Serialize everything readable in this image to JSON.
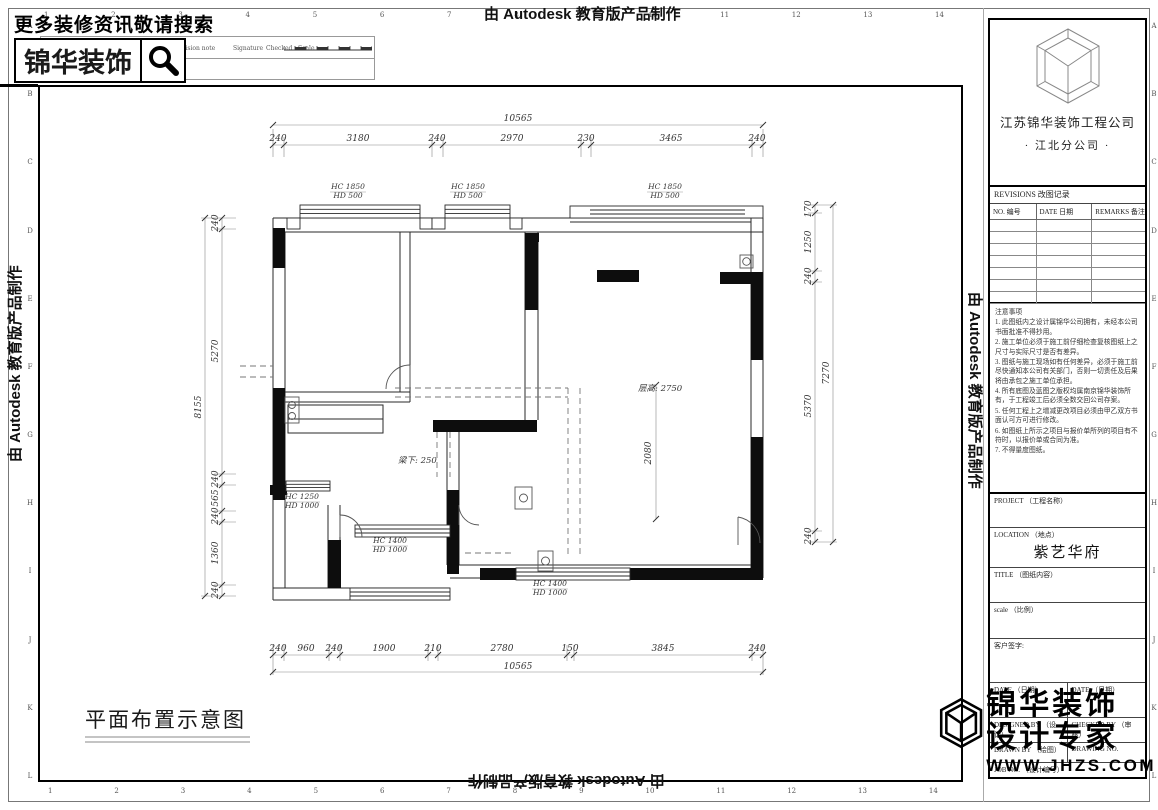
{
  "meta": {
    "ink": "#1a1a1a",
    "paper": "#ffffff"
  },
  "autodesk_stamp": "由 Autodesk 教育版产品制作",
  "header": {
    "search_hint": "更多装修资讯敬请搜索",
    "brand": "锦华装饰",
    "table": {
      "c1": "RevNo.",
      "c2": "Revision note",
      "c3": "Signature",
      "c4": "Checked",
      "c5": "Scale"
    }
  },
  "rulers": {
    "top_numbers": [
      "1",
      "2",
      "3",
      "4",
      "5",
      "6",
      "7",
      "8",
      "9",
      "10",
      "11",
      "12",
      "13",
      "14"
    ],
    "bottom_numbers": [
      "1",
      "2",
      "3",
      "4",
      "5",
      "6",
      "7",
      "8",
      "9",
      "10",
      "11",
      "12",
      "13",
      "14"
    ],
    "left_letters": [
      "A",
      "B",
      "C",
      "D",
      "E",
      "F",
      "G",
      "H",
      "I",
      "J",
      "K",
      "L"
    ],
    "right_letters": [
      "A",
      "B",
      "C",
      "D",
      "E",
      "F",
      "G",
      "H",
      "I",
      "J",
      "K",
      "L"
    ]
  },
  "plan": {
    "caption": "平面布置示意图",
    "dims_top": {
      "overall": "10565",
      "segments": [
        "240",
        "3180",
        "240",
        "2970",
        "230",
        "3465",
        "240"
      ]
    },
    "dims_bottom": {
      "overall": "10565",
      "segments": [
        "240",
        "960",
        "240",
        "1900",
        "210",
        "2780",
        "150",
        "3845",
        "240"
      ]
    },
    "dims_left": {
      "overall": "8155",
      "segments": [
        "240",
        "5270",
        "240",
        "565",
        "240",
        "1360",
        "240"
      ]
    },
    "dims_right": {
      "overall": "7270",
      "segments": [
        "170",
        "1250",
        "240",
        "5370",
        "240"
      ]
    },
    "windows": {
      "w1": {
        "l1": "HC 1850",
        "l2": "HD 500"
      },
      "w2": {
        "l1": "HC 1850",
        "l2": "HD 500"
      },
      "w3": {
        "l1": "HC 1850",
        "l2": "HD 500"
      },
      "w4": {
        "l1": "HC 1250",
        "l2": "HD 1000"
      },
      "w5": {
        "l1": "HC 1400",
        "l2": "HD 1000"
      },
      "w6": {
        "l1": "HC 1400",
        "l2": "HD 1000"
      }
    },
    "labels": {
      "ceiling": "层高: 2750",
      "beam": "梁下: 250",
      "entry_dim": "2080"
    }
  },
  "titleblock": {
    "company_line1": "江苏锦华装饰工程公司",
    "company_line2": "·  江北分公司  ·",
    "revisions_title": "REVISIONS 改图记录",
    "rev_cols": {
      "no": "NO. 编号",
      "date": "DATE 日期",
      "remarks": "REMARKS 备注"
    },
    "notes_title": "注意事项",
    "notes": [
      "1. 此图纸内之设计属锦华公司拥有，未经本公司书面批准不得抄用。",
      "2. 施工单位必须于施工前仔细检查复核图纸上之尺寸与实际尺寸是否有差异。",
      "3. 图纸与施工现场如有任何差异，必须于施工前尽快通知本公司有关部门，否则一切责任及后果将由承包之施工单位承担。",
      "4. 所有底图及蓝图之版权均属南京锦华装饰所有，于工程竣工后必须全数交回公司存案。",
      "5. 任何工程上之增减更改项目必须由甲乙双方书面认可方可进行修改。",
      "6. 如图纸上所示之项目与报价单所列的项目有不符时，以报价单或合同为准。",
      "7. 不得量度图纸。"
    ],
    "fields": {
      "project": "PROJECT （工程名称）",
      "location": "LOCATION （地点）",
      "location_value": "紫艺华府",
      "title": "TITLE （图纸内容）",
      "scale": "scale （比例）",
      "client_sign": "客户签字:",
      "date_left": "DATE （日期）",
      "date_right": "DATE （日期）",
      "designed_by": "DESIGNED BY （设计）",
      "checked_by": "CHECKED BY （审核）",
      "drawn_by": "DRAWN BY （绘图）",
      "drawing_no": "DRAWING NO.",
      "job_no": "JOB NO. （设计编号）"
    },
    "watermark": {
      "brand_line1": "锦华装饰",
      "brand_line2": "设计专家",
      "site": "WWW.JHZS.COM"
    }
  }
}
